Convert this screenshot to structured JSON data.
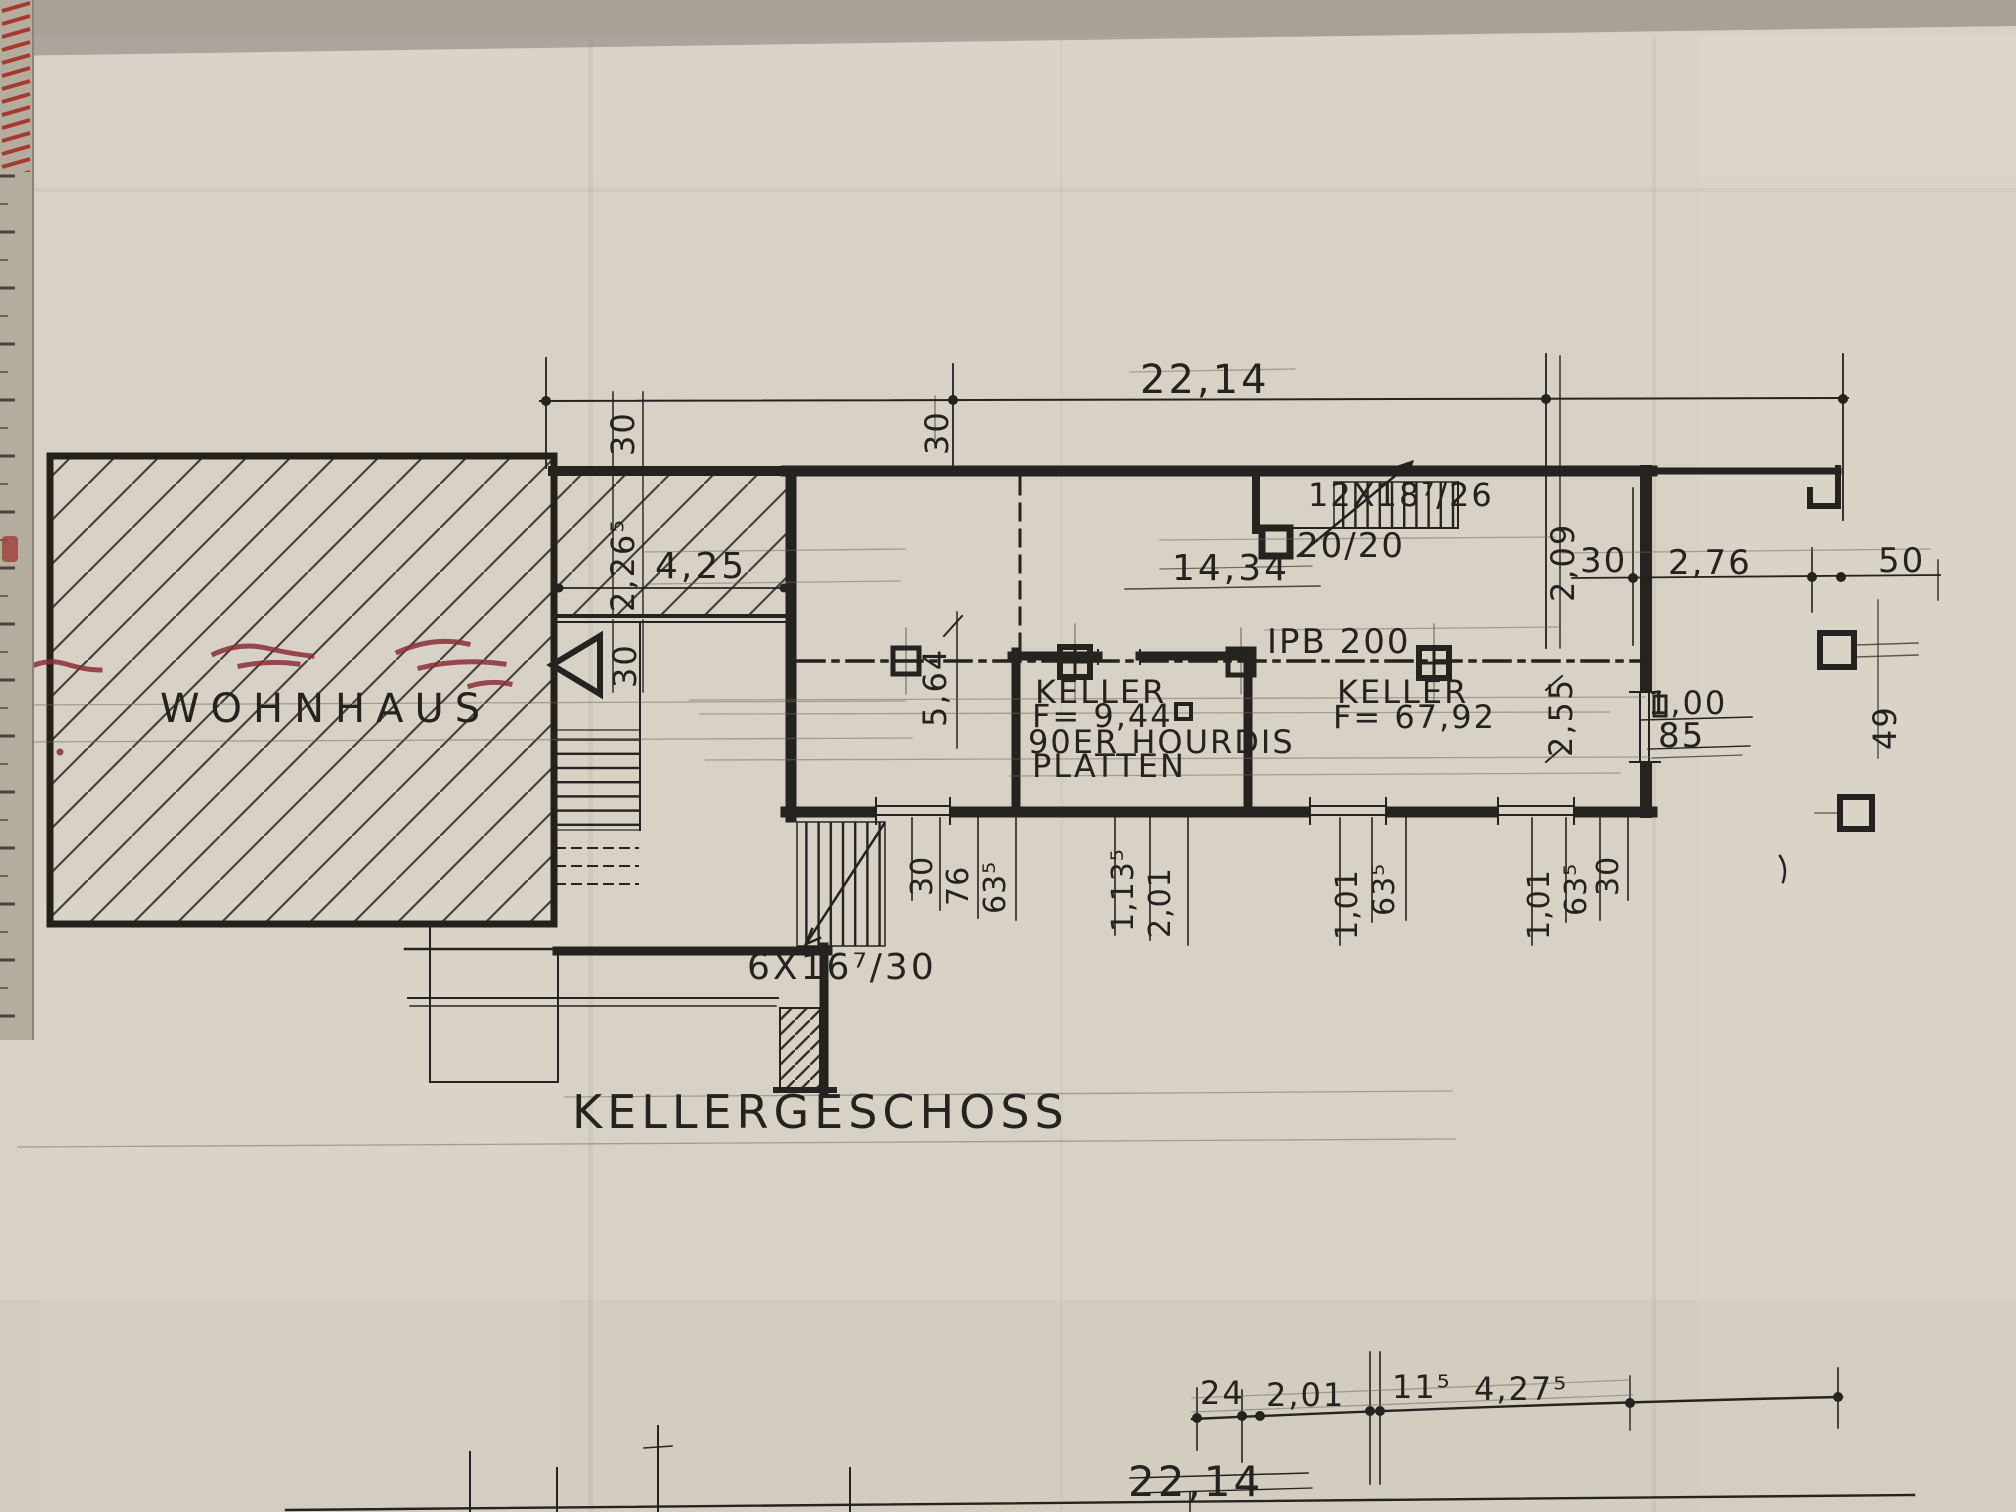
{
  "colors": {
    "background": "#a7a198",
    "paper": "#d8d2c6",
    "ink": "#25231f",
    "red_marks": "#8a2f36"
  },
  "title": "KELLERGESCHOSS",
  "labels": {
    "wohnhaus": "WOHNHAUS",
    "keller_small": {
      "name": "KELLER",
      "area": "F= 9,44"
    },
    "keller_large": {
      "name": "KELLER",
      "area": "F= 67,92"
    },
    "slab_note": {
      "line1": "90ER HOURDIS",
      "line2": "PLATTEN"
    },
    "beam": "IPB 200",
    "column": "20/20",
    "stair_upper": "12X18⁷/26",
    "stair_lower": "6X16⁷/30"
  },
  "dimensions": {
    "top_total": "22,14",
    "wall_30_top": "30",
    "anbau": {
      "width": "4,25",
      "depth": "2,26⁵",
      "wall_top": "30",
      "wall_bottom": "30"
    },
    "interior_width": "14,34",
    "room_depth": "5,64",
    "right_side": {
      "depth_top": "2,09",
      "wall": "30",
      "porch_width": "2,76",
      "offset": "50",
      "depth_bottom": "2,55",
      "door": "1,00",
      "door_clear": "85",
      "pier": "49"
    },
    "bottom_row": [
      "30",
      "76",
      "63⁵",
      "1,13⁵",
      "2,01",
      "1,01",
      "63⁵",
      "1,01",
      "63⁵",
      "30"
    ],
    "chain_row": [
      "24",
      "2,01",
      "11⁵",
      "4,27⁵"
    ],
    "bottom_total": "22,14"
  }
}
